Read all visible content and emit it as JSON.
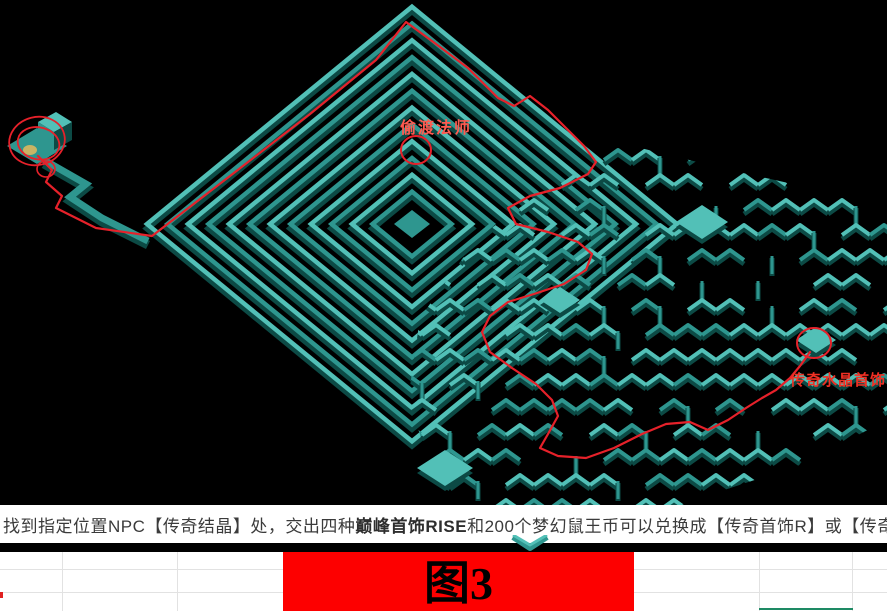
{
  "map": {
    "background": "#000000",
    "wall_light": "#52c0b7",
    "wall_mid": "#2e968f",
    "wall_dark": "#0c4a45",
    "path_color": "#e6212a",
    "annotation_color": "#e6212a",
    "item_color": "#c9b464",
    "labels": [
      {
        "id": "npc-teleport-mage-label",
        "text": "偷渡法师",
        "x": 436,
        "y": 133,
        "color": "#ff5a50",
        "size": 16,
        "spacing": 2
      },
      {
        "id": "legend-crystal-jewelry-label",
        "text": "传奇水晶首饰",
        "x": 838,
        "y": 385,
        "color": "#f03024",
        "size": 15,
        "spacing": 1
      }
    ],
    "markers": {
      "start_scribble": {
        "cx": 37,
        "cy": 141
      },
      "npc_circle": {
        "cx": 416,
        "cy": 150,
        "rx": 15,
        "ry": 14
      },
      "end_circle": {
        "cx": 814,
        "cy": 343,
        "rx": 17,
        "ry": 15
      }
    },
    "route": [
      [
        38,
        156
      ],
      [
        52,
        170
      ],
      [
        46,
        182
      ],
      [
        62,
        196
      ],
      [
        56,
        208
      ],
      [
        96,
        228
      ],
      [
        152,
        236
      ],
      [
        230,
        176
      ],
      [
        310,
        114
      ],
      [
        376,
        60
      ],
      [
        406,
        22
      ],
      [
        436,
        44
      ],
      [
        468,
        68
      ],
      [
        498,
        98
      ],
      [
        514,
        106
      ],
      [
        530,
        96
      ],
      [
        548,
        110
      ],
      [
        566,
        128
      ],
      [
        584,
        146
      ],
      [
        596,
        162
      ],
      [
        588,
        174
      ],
      [
        560,
        188
      ],
      [
        530,
        196
      ],
      [
        508,
        208
      ],
      [
        516,
        224
      ],
      [
        548,
        232
      ],
      [
        578,
        242
      ],
      [
        592,
        254
      ],
      [
        586,
        270
      ],
      [
        564,
        284
      ],
      [
        534,
        294
      ],
      [
        508,
        302
      ],
      [
        490,
        316
      ],
      [
        482,
        332
      ],
      [
        490,
        352
      ],
      [
        512,
        368
      ],
      [
        536,
        384
      ],
      [
        552,
        400
      ],
      [
        558,
        416
      ],
      [
        548,
        434
      ],
      [
        540,
        448
      ],
      [
        558,
        456
      ],
      [
        586,
        458
      ],
      [
        614,
        448
      ],
      [
        642,
        434
      ],
      [
        666,
        424
      ],
      [
        690,
        422
      ],
      [
        708,
        430
      ],
      [
        728,
        420
      ],
      [
        746,
        408
      ],
      [
        762,
        398
      ],
      [
        776,
        390
      ],
      [
        790,
        378
      ],
      [
        800,
        366
      ],
      [
        810,
        352
      ]
    ]
  },
  "caption": {
    "part1": "找到指定位置NPC【传奇结晶】处，交出四种",
    "bold": "巅峰首饰RISE",
    "part2": "和200个梦幻鼠王币可以兑换成【传奇首饰R】或【传奇水晶RISE】",
    "text_color": "#3b3b3b"
  },
  "figure": {
    "label": "图3",
    "background": "#fd0000",
    "text_color": "#000000"
  },
  "sheet": {
    "gridline_color": "#e2e2e2",
    "selection_color": "#1e8a64",
    "column_x": [
      62,
      177,
      759,
      852
    ],
    "row_y": [
      17,
      40
    ]
  }
}
